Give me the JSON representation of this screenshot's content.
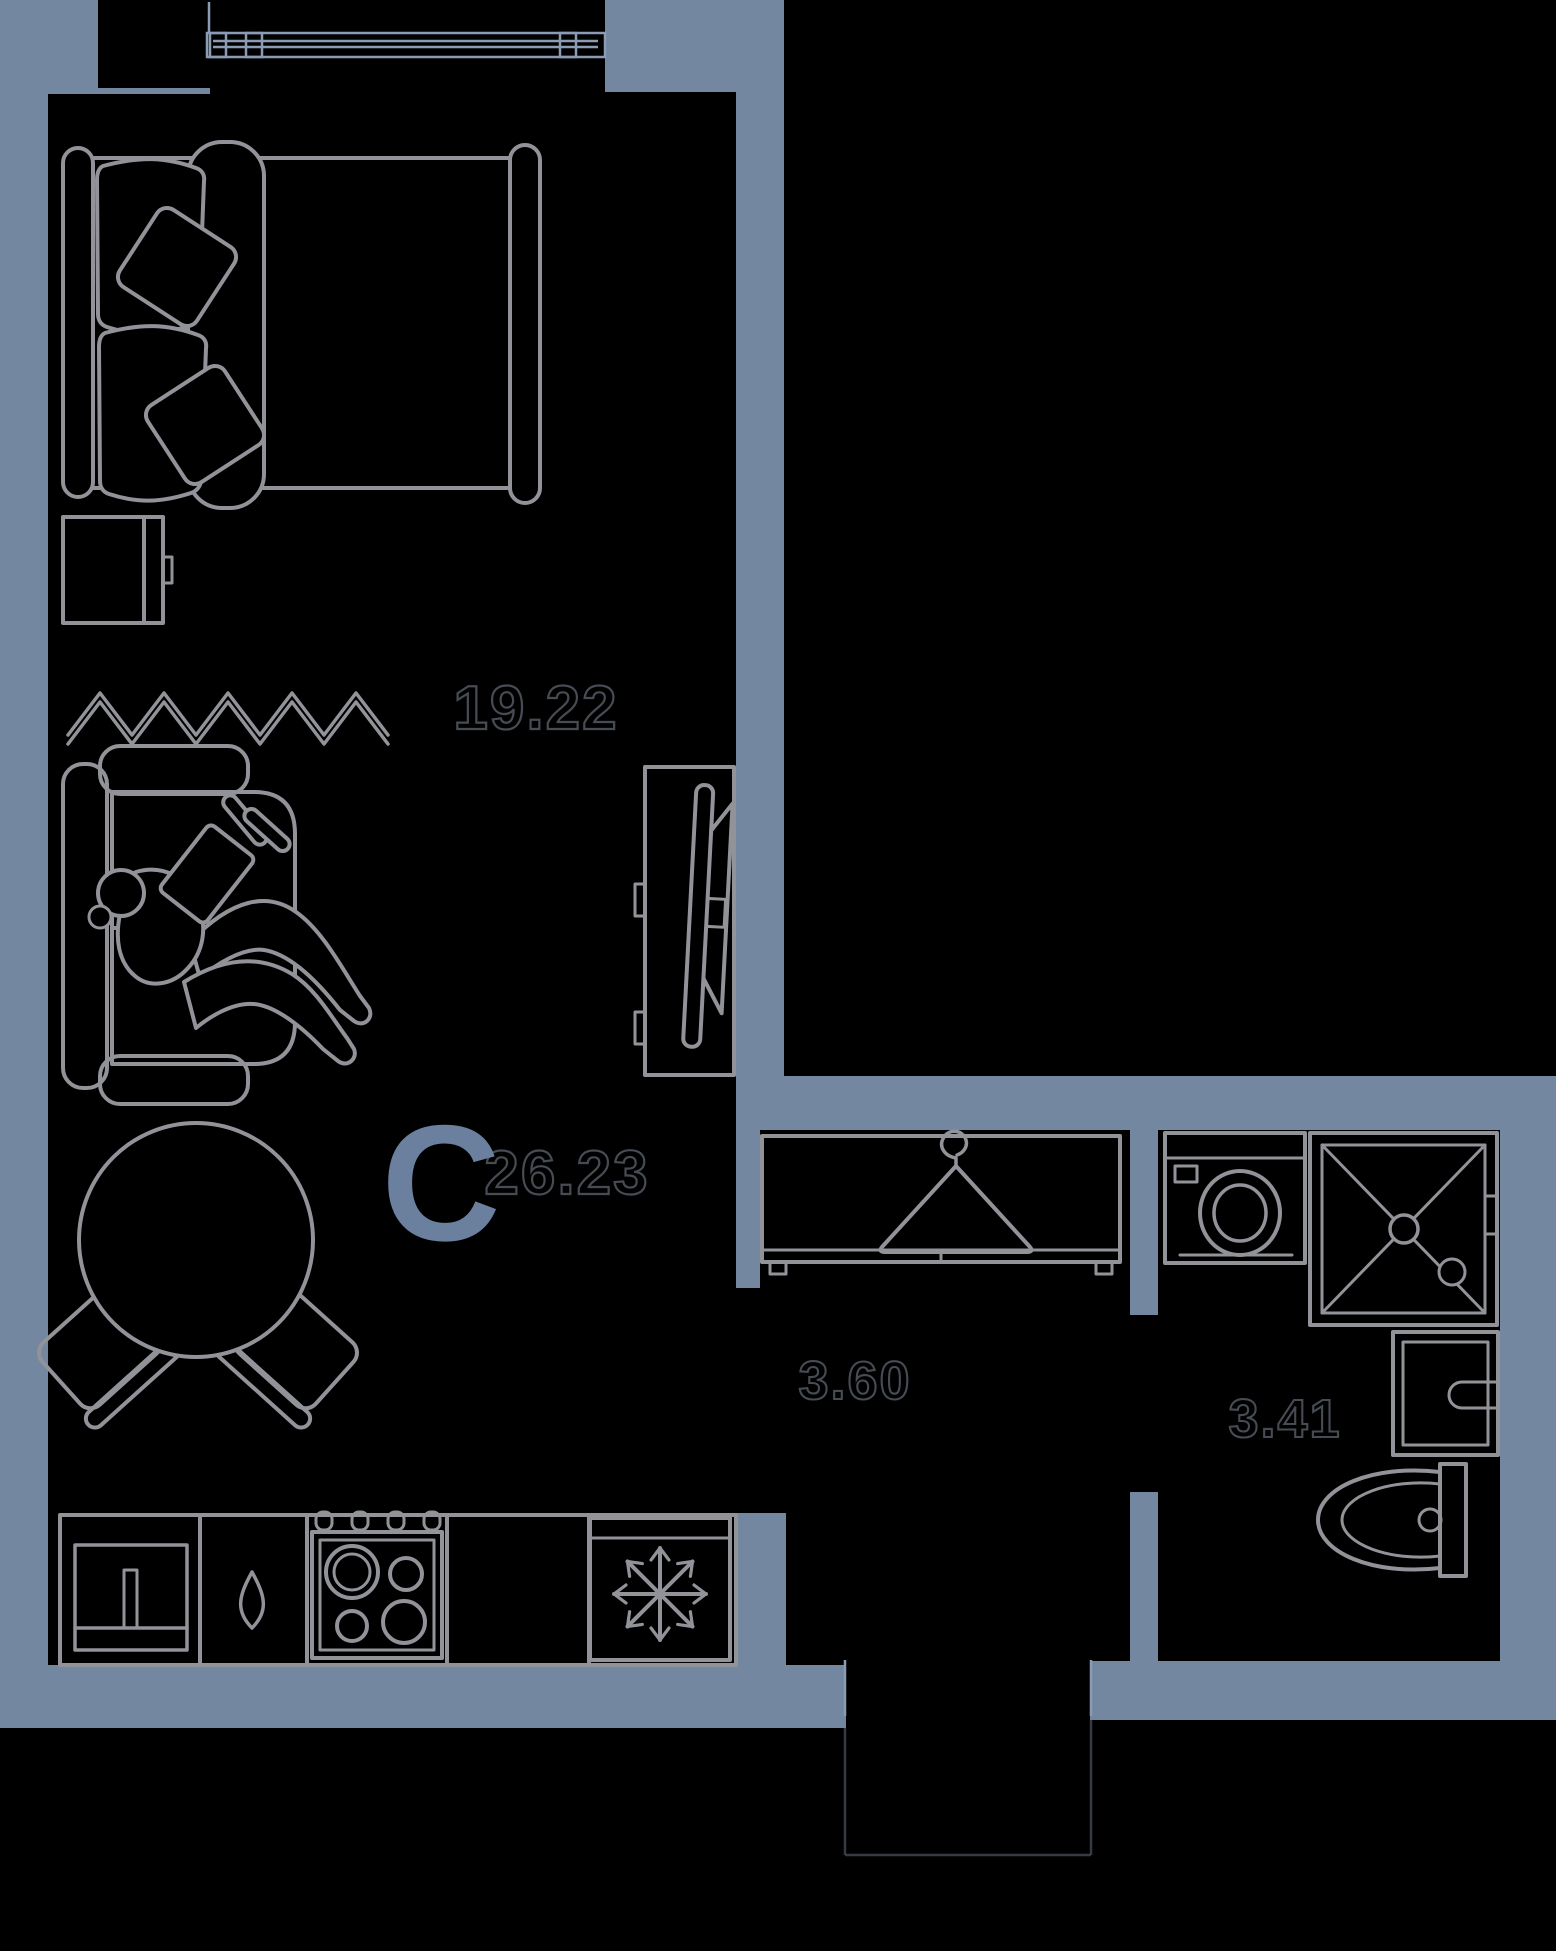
{
  "colors": {
    "background": "#000000",
    "wall": "#7487A0",
    "furniture_line": "#919399",
    "window_line": "#8C9BB4",
    "label_outline": "#474C54",
    "threshold_line": "#363A41",
    "studio_letter": "#6B7F9E"
  },
  "floor_plan": {
    "studio_letter": "C",
    "total_area": "26.23",
    "rooms": [
      {
        "id": "living-room",
        "area": "19.22"
      },
      {
        "id": "hallway",
        "area": "3.60"
      },
      {
        "id": "bathroom",
        "area": "3.41"
      }
    ],
    "icons": [
      "window-icon",
      "bed-icon",
      "pillow-icon",
      "nightstand-icon",
      "radiator-zigzag-icon",
      "sofa-icon",
      "person-reading-icon",
      "tv-unit-icon",
      "dining-table-icon",
      "chair-icon",
      "kitchen-sink-icon",
      "water-drop-icon",
      "stove-icon",
      "snowflake-fridge-icon",
      "hanger-icon",
      "washing-machine-icon",
      "shower-icon",
      "washbasin-icon",
      "toilet-icon",
      "door-opening"
    ]
  }
}
